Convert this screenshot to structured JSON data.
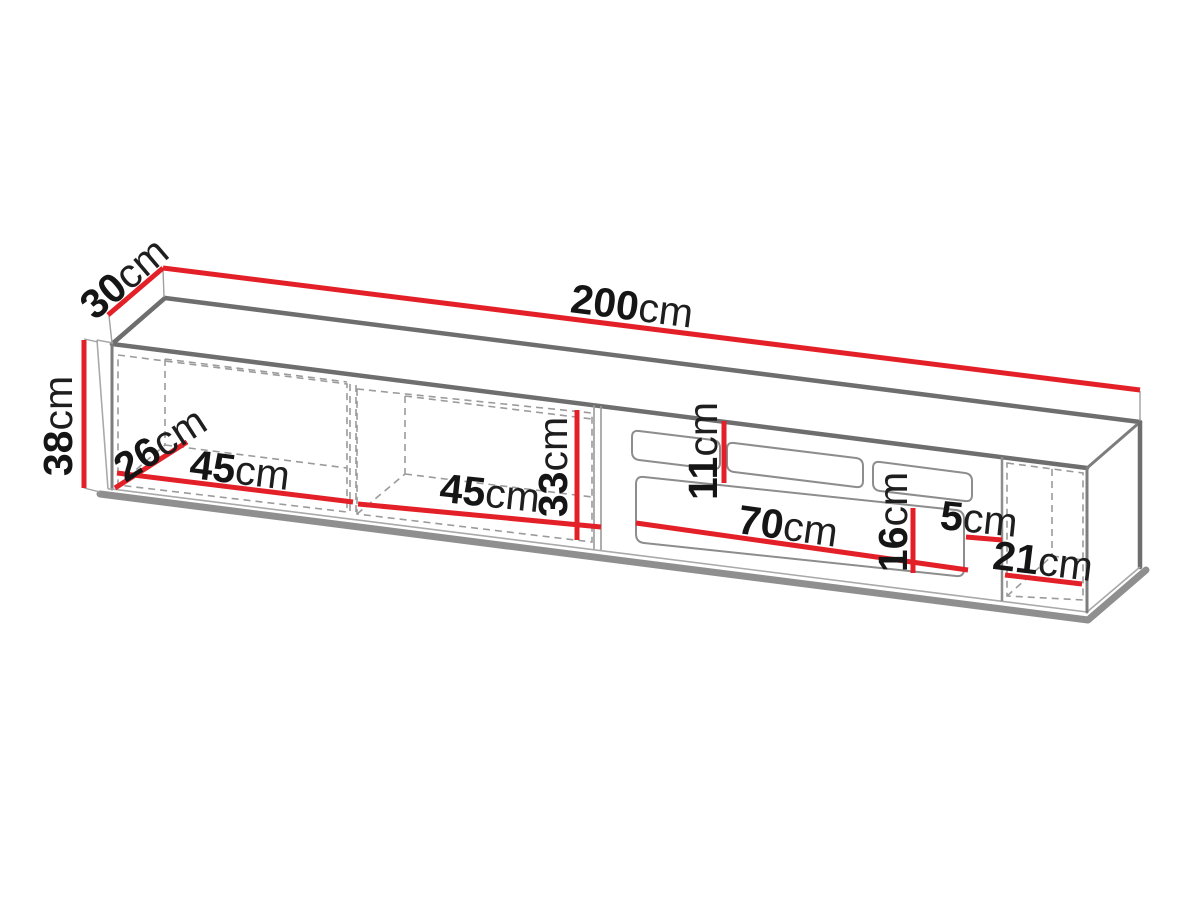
{
  "diagram": {
    "type": "furniture-dimension-drawing",
    "subject": "wall-mounted TV cabinet with two open shelves, flap drawers and right compartment",
    "unit": "cm",
    "colors": {
      "dimension_line": "#e32028",
      "outline_gray": "#6e6e6e",
      "label_text": "#151515"
    },
    "dims": [
      {
        "name": "total-width",
        "value": "200",
        "unit": "cm"
      },
      {
        "name": "total-depth",
        "value": "30",
        "unit": "cm"
      },
      {
        "name": "total-height",
        "value": "38",
        "unit": "cm"
      },
      {
        "name": "interior-depth",
        "value": "26",
        "unit": "cm"
      },
      {
        "name": "left-compartment-width",
        "value": "45",
        "unit": "cm"
      },
      {
        "name": "second-compartment-width",
        "value": "45",
        "unit": "cm"
      },
      {
        "name": "interior-height",
        "value": "33",
        "unit": "cm"
      },
      {
        "name": "top-niche-height",
        "value": "11",
        "unit": "cm"
      },
      {
        "name": "drawer-front-width",
        "value": "70",
        "unit": "cm"
      },
      {
        "name": "drawer-front-height",
        "value": "16",
        "unit": "cm"
      },
      {
        "name": "gap-width",
        "value": "5",
        "unit": "cm"
      },
      {
        "name": "right-compartment-width",
        "value": "21",
        "unit": "cm"
      }
    ]
  }
}
